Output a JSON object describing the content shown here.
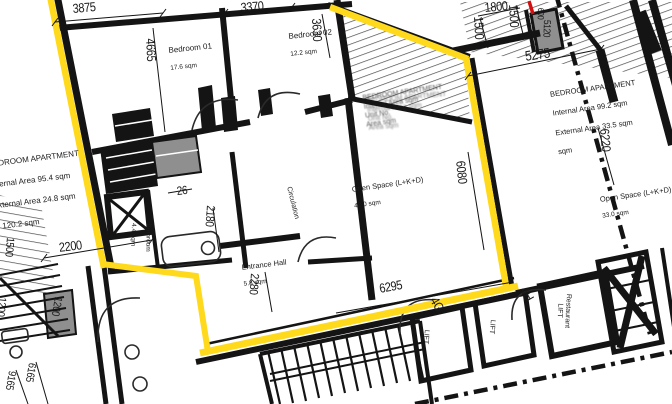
{
  "colors": {
    "highlight": "#ffd91c",
    "wall": "#141414",
    "gray": "#8f8f8f",
    "red": "#d40f0f",
    "hatch": "#4a4a4a"
  },
  "apartments": {
    "left": {
      "name": "BEDROOM APARTMENT",
      "line2": "Internal Area 95.4 sqm",
      "line3": "External Area 24.8 sqm",
      "line4": "T 120.2 sqm"
    },
    "right": {
      "name": "BEDROOM APARTMENT",
      "line2": "Internal Area 99.2 sqm",
      "line3": "External Area 33.5 sqm",
      "line4": "sqm"
    },
    "center_overlay": {
      "text": "BEDROOM APARTMENT\nInternal Area sqm\nUnit No.\nArea sqm"
    }
  },
  "rooms": {
    "bedroom01": {
      "name": "Bedroom 01",
      "area": "17.6 sqm"
    },
    "bedroom02": {
      "name": "Bedroom 02",
      "area": "12.2 sqm"
    },
    "open_space_center": {
      "name": "Open Space (L+K+D)",
      "area": "42.0 sqm"
    },
    "open_space_right": {
      "name": "Open Space (L+K+D)",
      "area": "33.0 sqm"
    },
    "entrance_hall": {
      "name": "Entrance Hall",
      "area": "5.8 sqm"
    },
    "bathroom": {
      "name": "Bathroom",
      "area": "4.4 sqm"
    },
    "circulation": {
      "name": "Circulation"
    },
    "lift_a": {
      "name": "LIFT"
    },
    "lift_b": {
      "name": "LIFT"
    },
    "restaurant_lift": {
      "name": "Restaurant\nLIFT"
    }
  },
  "units": {
    "g": "4G",
    "h": "4H"
  },
  "dimensions": {
    "d3875": "3875",
    "d3370": "3370",
    "d3630": "3630",
    "d4665": "4665",
    "d1800": "1800",
    "d1500a": "1500",
    "d1500b": "1500",
    "d600": "600",
    "d5120": "5120",
    "d5275": "5275",
    "d6220": "6220",
    "d6080": "6080",
    "d2200": "2200",
    "d1500left": "1500",
    "d26": "26",
    "d2180": "2180",
    "d2280": "2280",
    "d6295": "6295",
    "d1200box": "1200",
    "d1200left": "1200",
    "d6165": "6165",
    "d9165": "9165"
  }
}
